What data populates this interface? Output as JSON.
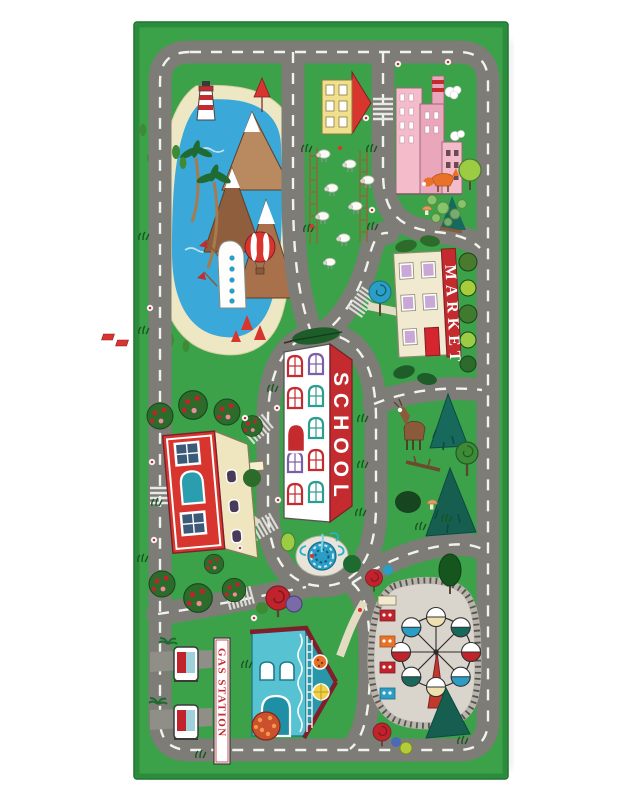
{
  "labels": {
    "school": "SCHOOL",
    "market": "MARKET",
    "gas_station": "GAS STATION"
  },
  "colors": {
    "background": "#ffffff",
    "rug_green": "#3ba24a",
    "rug_edge": "#2b8c3c",
    "road_gray": "#7d7c77",
    "road_marking": "#f2f2ee",
    "lake_blue": "#3aa8d8",
    "sand": "#eee7c4",
    "red_accent": "#c42b2f",
    "school_wall": "#ffffff",
    "market_wall": "#f1ead0",
    "teal_house": "#57c2d2",
    "ferris_ground": "#d9d5cc",
    "pine_teal": "#17695c",
    "leaf_dark_green": "#2d6b2a",
    "leaf_light_green": "#9bcc44",
    "factory_pink": "#f4bcca",
    "house_yellow": "#f0df8c"
  }
}
